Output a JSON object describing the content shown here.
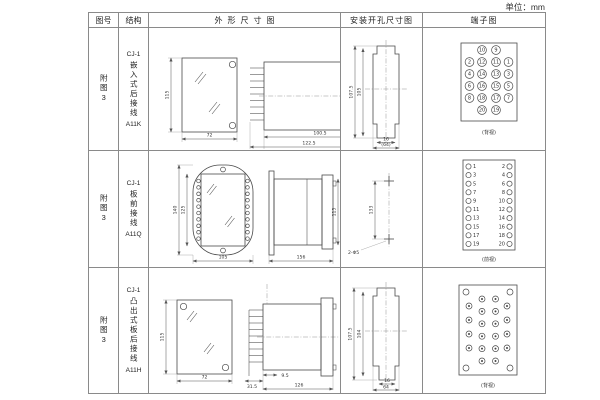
{
  "unit_label": "单位：mm",
  "headers": {
    "fig_no": "图号",
    "structure": "结构",
    "outline": "外形尺寸图",
    "install": "安装开孔尺寸图",
    "terminal": "端子图"
  },
  "table": {
    "rows": [
      {
        "fig_no": "附图3",
        "model": "CJ-1",
        "struct_type": "嵌入式后接线",
        "code": "A11K",
        "outline": {
          "h": "115",
          "w": "72",
          "l1": "100.5",
          "l2": "122.5",
          "l3": "35"
        },
        "install": {
          "h1": "107.5",
          "h2": "105",
          "w1": "16",
          "w2": "(64)"
        },
        "terminal": {
          "label": "(背视)",
          "outer_left": [
            "2",
            "4",
            "6",
            "8"
          ],
          "inner_left": [
            "10",
            "12",
            "14",
            "16",
            "18",
            "20"
          ],
          "inner_right": [
            "9",
            "11",
            "13",
            "15",
            "17",
            "19"
          ],
          "outer_right": [
            "1",
            "3",
            "5",
            "7"
          ]
        }
      },
      {
        "fig_no": "附图3",
        "model": "CJ-1",
        "struct_type": "板前接线",
        "code": "A11Q",
        "outline": {
          "h1": "140",
          "h2": "125",
          "w": "105",
          "l": "156",
          "hs": "115"
        },
        "install": {
          "spacing": "133",
          "hole_label": "2-Φ5"
        },
        "terminal": {
          "label": "(前视)",
          "left": [
            "1",
            "3",
            "5",
            "7",
            "9",
            "11",
            "13",
            "15",
            "17",
            "19"
          ],
          "right": [
            "2",
            "4",
            "6",
            "8",
            "10",
            "12",
            "14",
            "16",
            "18",
            "20"
          ]
        }
      },
      {
        "fig_no": "附图3",
        "model": "CJ-1",
        "struct_type": "凸出式板后接线",
        "code": "A11H",
        "outline": {
          "h": "115",
          "w": "72",
          "l1": "31.5",
          "l2": "9.5",
          "l3": "126"
        },
        "install": {
          "h1": "107.5",
          "h2": "104",
          "w1": "16",
          "w2": "64"
        },
        "terminal": {
          "label": "(背视)"
        }
      }
    ]
  }
}
